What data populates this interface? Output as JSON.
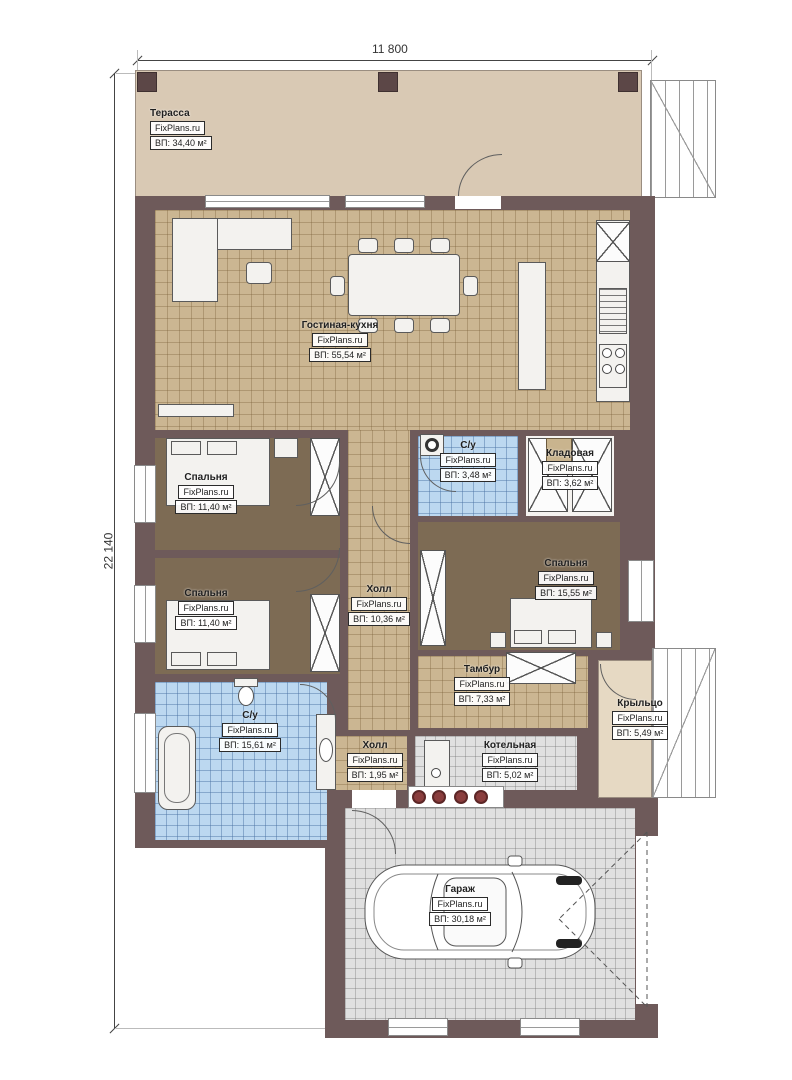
{
  "brand": "FixPlans.ru",
  "dims": {
    "width_label": "11 800",
    "height_label": "22 140"
  },
  "rooms": [
    {
      "id": "terrace",
      "name": "Терасса",
      "area": "ВП: 34,40 м²"
    },
    {
      "id": "living",
      "name": "Гостиная-кухня",
      "area": "ВП: 55,54 м²"
    },
    {
      "id": "bedroom1",
      "name": "Спальня",
      "area": "ВП: 11,40 м²"
    },
    {
      "id": "bedroom2",
      "name": "Спальня",
      "area": "ВП: 11,40 м²"
    },
    {
      "id": "su_small",
      "name": "С/у",
      "area": "ВП: 3,48 м²"
    },
    {
      "id": "kladovaya",
      "name": "Кладовая",
      "area": "ВП: 3,62 м²"
    },
    {
      "id": "bedroom3",
      "name": "Спальня",
      "area": "ВП: 15,55 м²"
    },
    {
      "id": "hall",
      "name": "Холл",
      "area": "ВП: 10,36 м²"
    },
    {
      "id": "tambur",
      "name": "Тамбур",
      "area": "ВП: 7,33 м²"
    },
    {
      "id": "porch",
      "name": "Крыльцо",
      "area": "ВП: 5,49 м²"
    },
    {
      "id": "su_big",
      "name": "С/у",
      "area": "ВП: 15,61 м²"
    },
    {
      "id": "hall_small",
      "name": "Холл",
      "area": "ВП: 1,95 м²"
    },
    {
      "id": "boiler",
      "name": "Котельная",
      "area": "ВП: 5,02 м²"
    },
    {
      "id": "garage",
      "name": "Гараж",
      "area": "ВП: 30,18 м²"
    }
  ],
  "colors": {
    "wall": "#6e5a5a",
    "terrace": "#d9c9b4",
    "tile_tan": "#cbb692",
    "carpet": "#7d6b54",
    "tile_blue": "#bcd8f0",
    "tile_gray": "#e0e0e0",
    "porch": "#e6d9c3",
    "furniture": "#f3f2ef",
    "red_dots": "#8a3d3d",
    "label_ink": "#1f1f1f"
  }
}
